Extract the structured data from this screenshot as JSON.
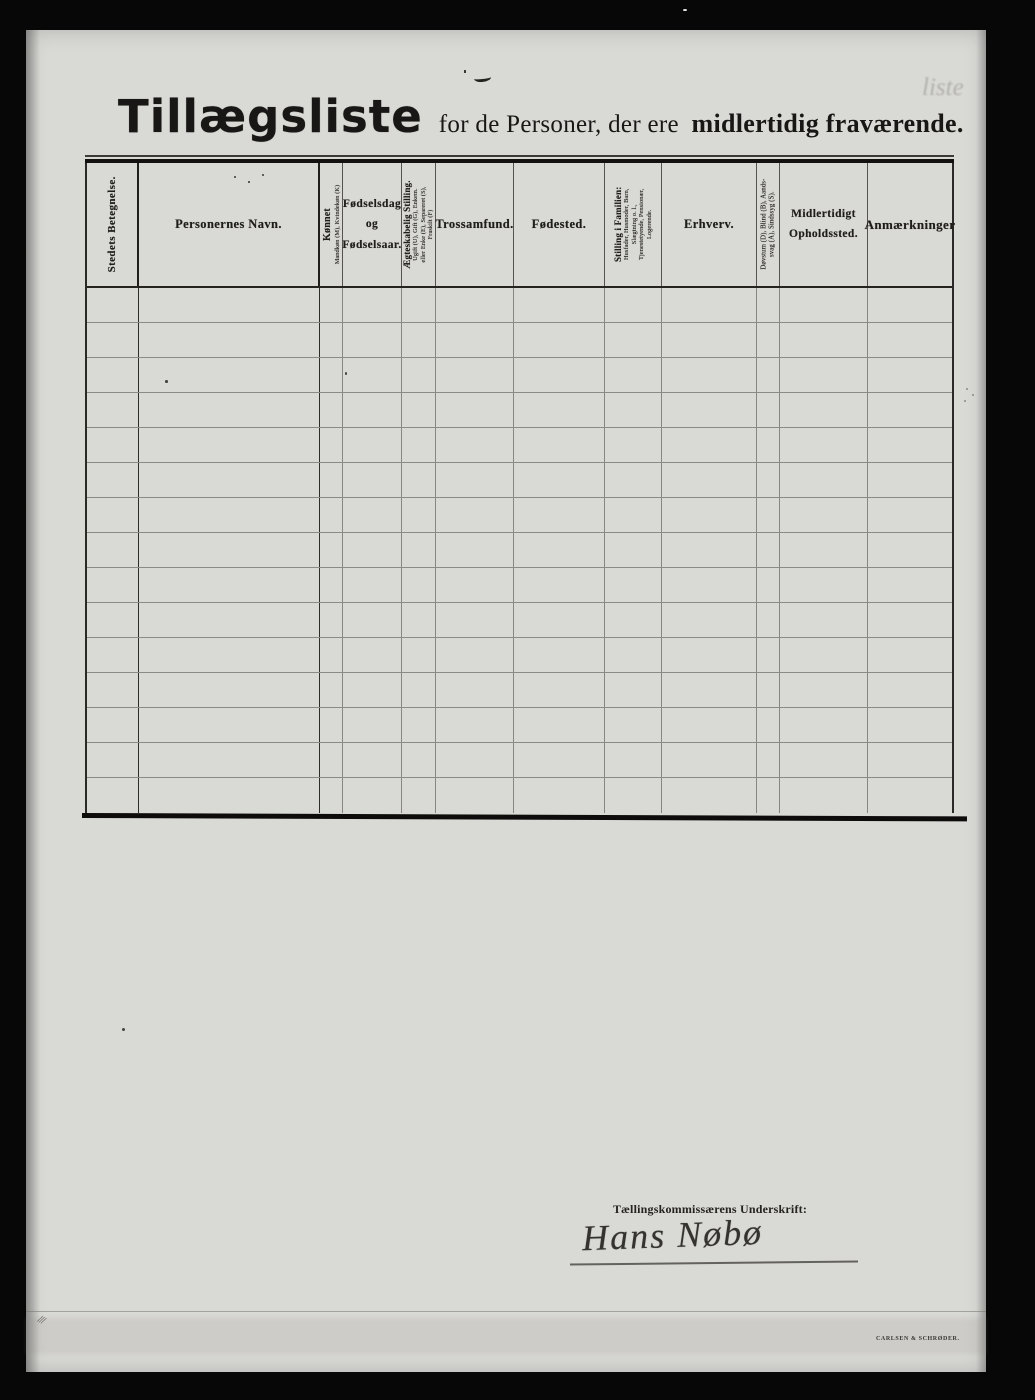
{
  "document": {
    "title": {
      "main": "Tillægsliste",
      "subtitle_regular": "for de Personer, der ere",
      "subtitle_bold": "midlertidig fraværende."
    }
  },
  "table": {
    "empty_row_count": 15,
    "columns": [
      {
        "label": "Stedets Betegnelse."
      },
      {
        "label": "Personernes Navn."
      },
      {
        "label": "Kønnet",
        "sub_lines": [
          "Mandkøn (M), Kvindekøn (K)"
        ]
      },
      {
        "label_lines": [
          "Fødselsdag",
          "og",
          "Fødselsaar."
        ]
      },
      {
        "label": "Ægteskabelig Stilling.",
        "sub_lines": [
          "Ugift (U), Gift (G), Enkem.",
          "eller Enke (E), Separeret (S),",
          "Fraskilt (F)"
        ]
      },
      {
        "label": "Trossamfund."
      },
      {
        "label": "Fødested."
      },
      {
        "label": "Stilling i Familien:",
        "sub_lines": [
          "Husfader, Husmoder, Barn,",
          "Slægtning o. l.,",
          "Tjenestetyende, Pensionær,",
          "Logerende."
        ]
      },
      {
        "label": "Erhverv."
      },
      {
        "label_lines": [
          "Døvstum (D), Blind (B), Aands-",
          "svag (A), Sindssyg (S)."
        ]
      },
      {
        "label_lines": [
          "Midlertidigt",
          "Opholdssted."
        ]
      },
      {
        "label": "Anmærkninger"
      }
    ]
  },
  "signature": {
    "label": "Tællingskommissærens Underskrift:",
    "name": "Hans Nøbø"
  },
  "imprint": "CARLSEN & SCHRØDER."
}
